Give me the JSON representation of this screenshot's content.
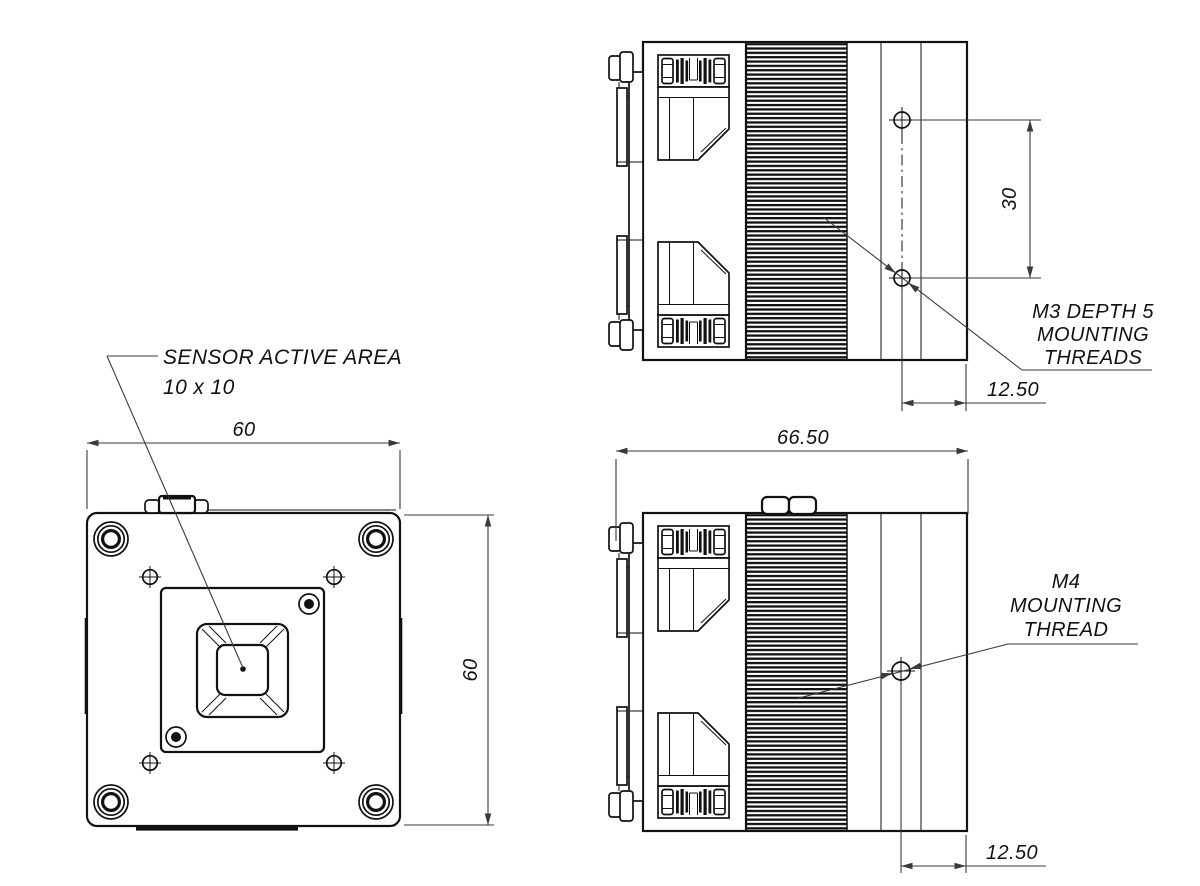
{
  "drawing": {
    "colors": {
      "background": "#ffffff",
      "lines": "#111111",
      "dimensions": "#3a3a3a"
    },
    "front_view": {
      "width_dim": "60",
      "height_dim": "60",
      "sensor_callout_line1": "SENSOR ACTIVE AREA",
      "sensor_callout_line2": "10 x 10"
    },
    "top_side_view": {
      "hole_spacing_dim": "30",
      "thread_offset_dim": "12.50",
      "callout_line1": "M3 DEPTH 5",
      "callout_line2": "MOUNTING",
      "callout_line3": "THREADS"
    },
    "bottom_side_view": {
      "length_dim": "66.50",
      "thread_offset_dim": "12.50",
      "callout_line1": "M4",
      "callout_line2": "MOUNTING",
      "callout_line3": "THREAD"
    }
  }
}
